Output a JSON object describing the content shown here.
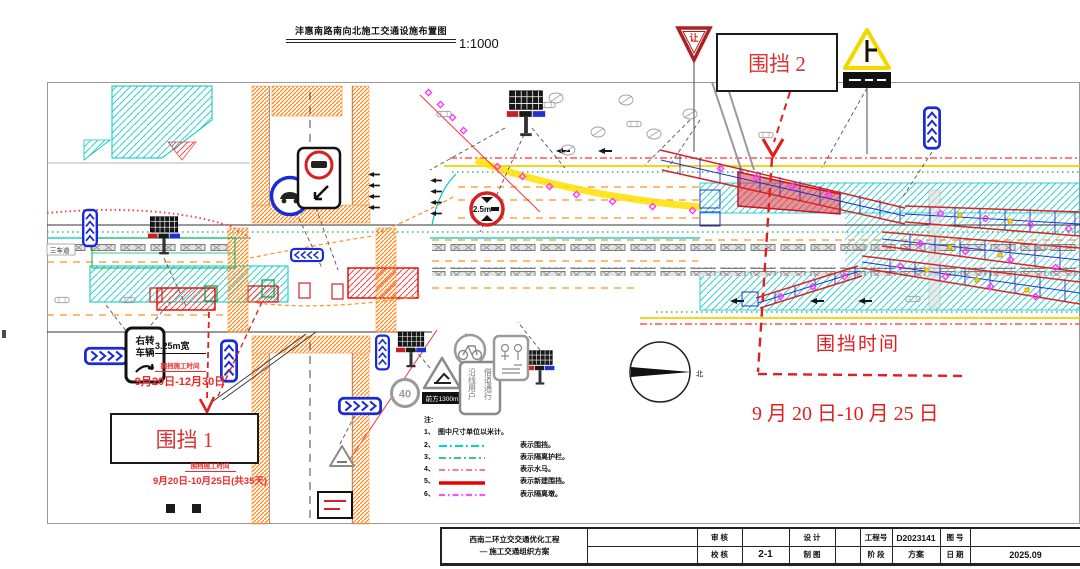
{
  "title": {
    "text": "沣惠南路南向北施工交通设施布置图",
    "scale": "1:1000"
  },
  "compass": {
    "north_label": "北"
  },
  "road_labels": {
    "left_lane_label": "三车道"
  },
  "annotations": {
    "enclosure1_label": "围挡 1",
    "enclosure2_label": "围挡 2",
    "time_title": "围挡时间",
    "time_range": "9 月 20 日-10 月 25 日",
    "worktime1_title": "围挡施工时间",
    "worktime1_range": "9月20日-12月30日",
    "worktime2_title": "围挡施工时间",
    "worktime2_range": "9月20日-10月25日(共35天)",
    "lane_width": "3.25m宽"
  },
  "signs": {
    "yield_label": "让",
    "right_turn_line1": "右转",
    "right_turn_line2": "车辆",
    "speed_limit": "40",
    "height_limit": "2.5m",
    "construction_plate": "前方1300m",
    "detour_col1": "沿线用户",
    "detour_col2": "借道通行"
  },
  "legend": {
    "heading": "注:",
    "items": [
      {
        "no": "1、",
        "text": "图中尺寸单位以米计。",
        "color": ""
      },
      {
        "no": "2、",
        "text": "表示围挡。",
        "color": "#00d5d5"
      },
      {
        "no": "3、",
        "text": "表示隔离护栏。",
        "color": "#00b050"
      },
      {
        "no": "4、",
        "text": "表示水马。",
        "color": "#ff5050"
      },
      {
        "no": "5、",
        "text": "表示新建围挡。",
        "color": "#e60000"
      },
      {
        "no": "6、",
        "text": "表示隔离墩。",
        "color": "#ff50ff"
      }
    ]
  },
  "colors": {
    "annotation_red": "#e02020",
    "enclosure_cyan": "#00d5d5",
    "barrier_magenta": "#ff33ff",
    "structure_blue": "#2233cc",
    "structure_red": "#dd2222",
    "crosswalk_orange": "#ff8a20"
  },
  "titleblock": {
    "project_line1": "西南二环立交交通优化工程",
    "project_line2": "— 施工交通组织方案",
    "review_label": "审 核",
    "review_value": "",
    "check_label": "校 核",
    "check_value": "2-1",
    "design_label": "设 计",
    "design_value": "",
    "draft_label": "制 图",
    "draft_value": "",
    "project_no_label": "工程号",
    "project_no_value": "D2023141",
    "stage_label": "阶 段",
    "stage_value": "方案",
    "drawing_no_label": "图 号",
    "drawing_no_value": "",
    "date_label": "日 期",
    "date_value": "2025.09"
  }
}
